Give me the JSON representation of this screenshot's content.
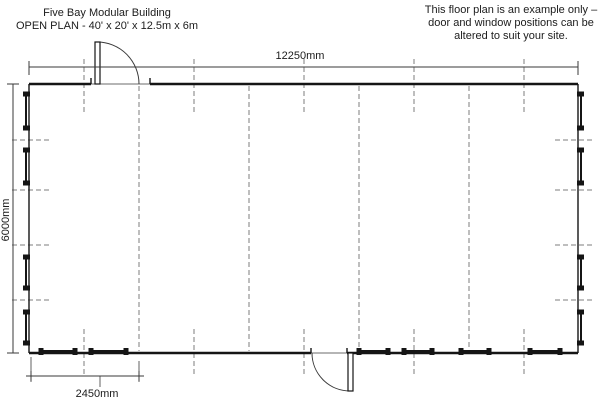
{
  "title": {
    "line1": "Five Bay Modular Building",
    "line2": "OPEN PLAN - 40' x 20' x 12.5m x 6m"
  },
  "note": {
    "line1": "This floor plan is an example only –",
    "line2": "door and window positions can be",
    "line3": "altered to suit your site."
  },
  "dimension_labels": {
    "overall_width": "12250mm",
    "overall_depth": "6000mm",
    "bay_width": "2450mm"
  },
  "colors": {
    "wall": "#151515",
    "thin_line": "#3a3a3a",
    "dashed": "#7d7d7d",
    "text": "#1c1c1c",
    "background": "#ffffff"
  },
  "plan": {
    "bays": 5,
    "outline": {
      "left": 29,
      "top": 84,
      "right": 578,
      "bottom": 353
    },
    "top_dim": {
      "y": 67
    },
    "left_dim": {
      "x": 13
    },
    "bay_dim": {
      "x1": 31,
      "x2": 139,
      "y": 376,
      "line_x1": 26,
      "line_x2": 144,
      "leader_x": 100,
      "leader_y2": 387
    },
    "bay_joints_x": [
      139,
      249,
      359,
      469
    ],
    "bay_centers_x": [
      84,
      194,
      304,
      414,
      524
    ],
    "bay_center_top_y": [
      59,
      114
    ],
    "bay_center_bottom_y": [
      329,
      375
    ],
    "side_marks_y": [
      140,
      190,
      245,
      300
    ],
    "side_windows_y": [
      [
        94,
        128
      ],
      [
        150,
        183
      ],
      [
        257,
        288
      ],
      [
        312,
        343
      ]
    ],
    "bottom_windows_x": [
      [
        41,
        75
      ],
      [
        91,
        126
      ],
      [
        359,
        388
      ],
      [
        404,
        432
      ],
      [
        461,
        489
      ],
      [
        530,
        560
      ]
    ],
    "top_door": {
      "gap1": 91,
      "gap2": 150,
      "leaf_x": 95,
      "leaf_w": 5,
      "leaf_top": 42
    },
    "bottom_door": {
      "gap1": 311,
      "gap2": 347,
      "leaf_x": 348,
      "leaf_w": 5,
      "leaf_bottom": 391
    }
  }
}
